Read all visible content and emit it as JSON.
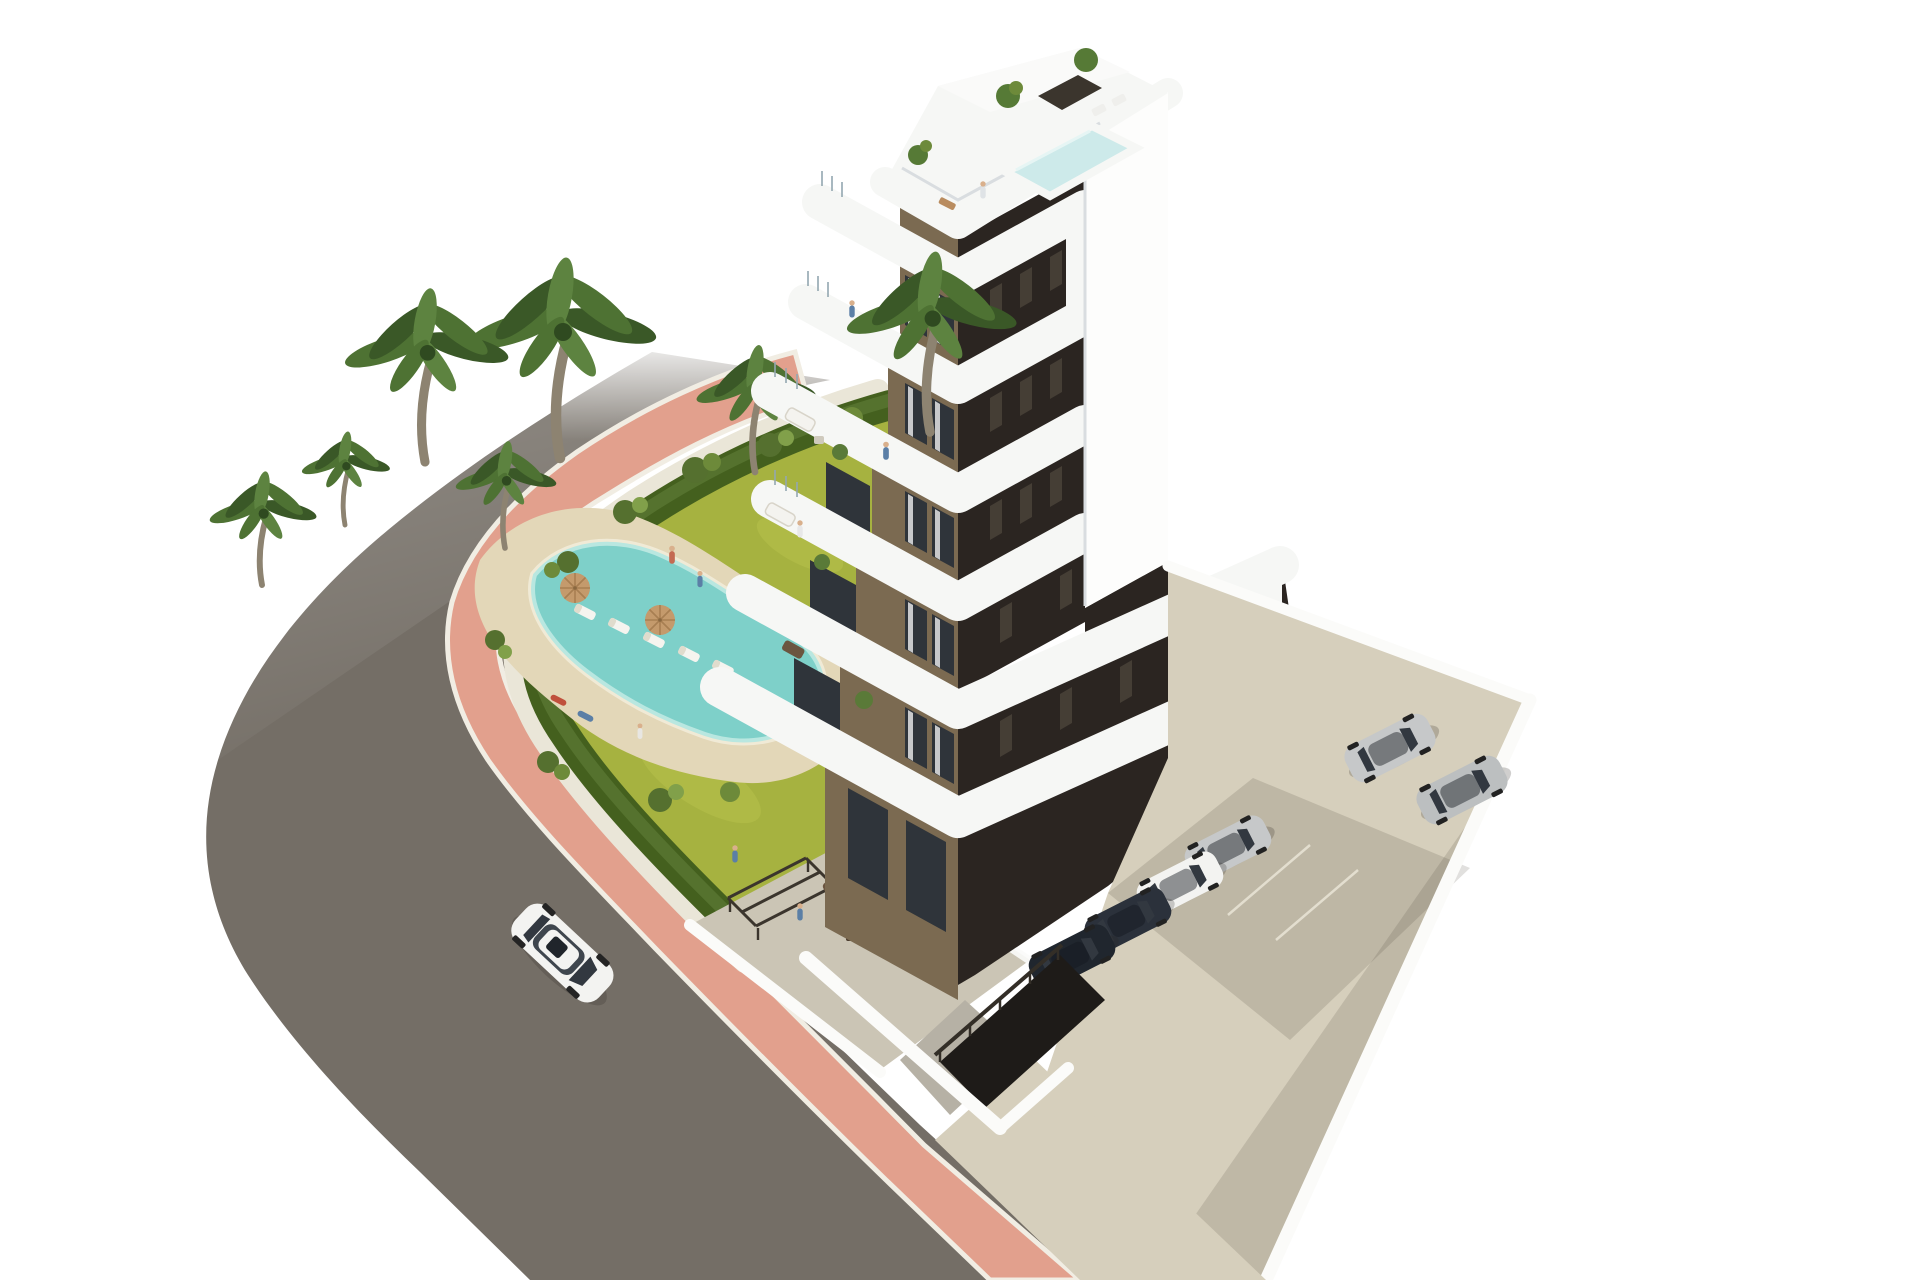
{
  "scene": {
    "title": "3D architectural rendering of a modern apartment residence",
    "description": "Aerial white-background render: curved asphalt road with pink sidewalk, landscaped garden with kidney-shaped pool and palm trees, stepped white apartment tower with brown facades and rounded white balconies, rooftop pool terrace, side parking lot with cars, single white car driving on the road.",
    "colors": {
      "background": "#ffffff",
      "asphalt": "#746e66",
      "curb": "#f1ede3",
      "sidewalk": "#e2a08d",
      "gravel": "#eae6d8",
      "hedge": "#44601e",
      "hedge_light": "#587631",
      "grass": "#a6b240",
      "grass_light": "#bac44e",
      "pool_deck": "#e3d7b8",
      "pool_water": "#7ed0c9",
      "pool_water_light": "#b9e7e0",
      "pool_coping": "#f0ead6",
      "palm_frond": "#4e7233",
      "palm_frond_dark": "#3a5827",
      "palm_trunk": "#8d8371",
      "band_white": "#f6f7f5",
      "facade_brown": "#7b6a51",
      "facade_dark": "#2b2521",
      "window_glass": "#2f343a",
      "ne_wall_white": "#fdfdfc",
      "roof_pool": "#cdeaea",
      "concrete": "#d6cfbc",
      "concrete_shadow": "#b9b2a0",
      "wall_white": "#fbfbf9",
      "terrace_floor": "#cbc5b5",
      "car_white": "#f3f3f1",
      "car_silver": "#c6c8c9",
      "car_dark": "#2b313b",
      "pergola": "#3b352d",
      "ramp": "#1e1b18",
      "umbrella": "#c49a6c",
      "people_blue": "#5b7fa6",
      "skin": "#d9b08c"
    },
    "counts": {
      "floors_visible": 7,
      "palm_trees": 7,
      "sun_loungers": 5,
      "pool_umbrellas": 2,
      "cars_parked_upper": 2,
      "cars_parked_under_building": 4,
      "cars_on_road": 1,
      "people_visible": 12
    },
    "objects": [
      "curved-road",
      "pink-sidewalk",
      "garden",
      "swimming-pool",
      "pool-deck",
      "palm-trees",
      "hedge",
      "apartment-building",
      "balcony-bands",
      "rooftop-terrace",
      "rooftop-pool",
      "parking-lot",
      "parked-cars",
      "garage-ramp",
      "white-car",
      "communal-terrace"
    ]
  }
}
